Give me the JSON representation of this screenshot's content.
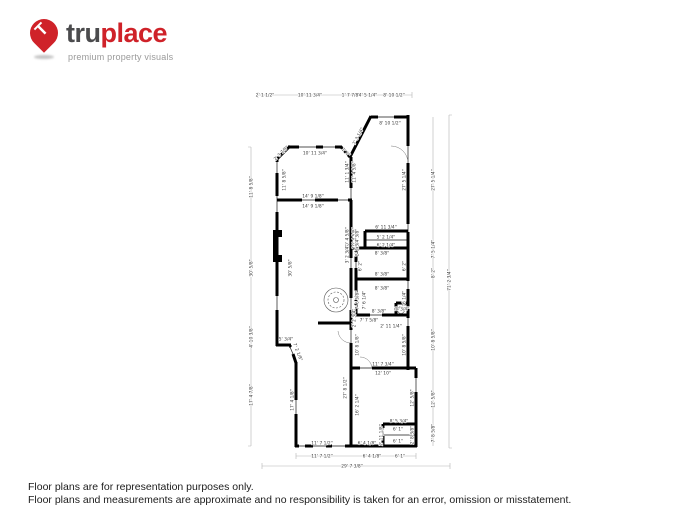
{
  "logo": {
    "pin_letter": "T",
    "brand_bold": "tru",
    "brand_accent": "place",
    "tagline": "premium property visuals",
    "accent_color": "#cf2229",
    "text_color": "#4b4b4d"
  },
  "disclaimer": {
    "line1": "Floor plans are for representation purposes only.",
    "line2": "Floor plans and measurements are approximate and no responsibility is taken for an error, omission or misstatement."
  },
  "floorplan": {
    "labels": [
      {
        "t": "2' 1 1/2\"",
        "x": 265,
        "y": 95,
        "r": 0
      },
      {
        "t": "10' 11 3/4\"",
        "x": 310,
        "y": 95,
        "r": 0
      },
      {
        "t": "1' 7 7/8\"",
        "x": 351,
        "y": 95,
        "r": 0
      },
      {
        "t": "4' 5 1/4\"",
        "x": 368,
        "y": 95,
        "r": 0
      },
      {
        "t": "8' 10 1/2\"",
        "x": 394,
        "y": 95,
        "r": 0
      },
      {
        "t": "8' 10 1/2\"",
        "x": 390,
        "y": 123,
        "r": 0
      },
      {
        "t": "10' 11 3/4\"",
        "x": 315,
        "y": 153,
        "r": 0
      },
      {
        "t": "2' 3 7/8\"",
        "x": 281,
        "y": 153,
        "r": -45
      },
      {
        "t": "1' 1\"",
        "x": 346,
        "y": 152,
        "r": 45
      },
      {
        "t": "7' 3 1/4\"",
        "x": 358,
        "y": 136,
        "r": -62
      },
      {
        "t": "11' 8 5/8\"",
        "x": 251,
        "y": 187,
        "r": -90
      },
      {
        "t": "30' 5/8\"",
        "x": 251,
        "y": 268,
        "r": -90
      },
      {
        "t": "4' 10 3/8\"",
        "x": 251,
        "y": 337,
        "r": -90
      },
      {
        "t": "17' 4 7/8\"",
        "x": 251,
        "y": 395,
        "r": -90
      },
      {
        "t": "11' 8 5/8\"",
        "x": 284,
        "y": 180,
        "r": -90
      },
      {
        "t": "30' 5/8\"",
        "x": 290,
        "y": 268,
        "r": -90
      },
      {
        "t": "11' 1 3/4\"",
        "x": 347,
        "y": 172,
        "r": -90
      },
      {
        "t": "11' 4 5/8\"",
        "x": 354,
        "y": 172,
        "r": -90
      },
      {
        "t": "10' 4 5/8\"",
        "x": 347,
        "y": 238,
        "r": -90
      },
      {
        "t": "10' 4 5/8\"",
        "x": 354,
        "y": 238,
        "r": -90
      },
      {
        "t": "27' 5 1/4\"",
        "x": 404,
        "y": 180,
        "r": -90
      },
      {
        "t": "27' 5 1/4\"",
        "x": 433,
        "y": 180,
        "r": -90
      },
      {
        "t": "7' 5 1/4\"",
        "x": 433,
        "y": 249,
        "r": -90
      },
      {
        "t": "8' 2\"",
        "x": 433,
        "y": 273,
        "r": -90
      },
      {
        "t": "10' 8 5/8\"",
        "x": 433,
        "y": 340,
        "r": -90
      },
      {
        "t": "12' 5/8\"",
        "x": 433,
        "y": 399,
        "r": -90
      },
      {
        "t": "7' 8 5/8\"",
        "x": 433,
        "y": 433,
        "r": -90
      },
      {
        "t": "71' 2 3/4\"",
        "x": 449,
        "y": 280,
        "r": -90
      },
      {
        "t": "14' 9 1/8\"",
        "x": 313,
        "y": 196,
        "r": 0
      },
      {
        "t": "14' 9 1/8\"",
        "x": 313,
        "y": 206,
        "r": 0
      },
      {
        "t": "6' 11 3/4\"",
        "x": 386,
        "y": 227,
        "r": 0
      },
      {
        "t": "5' 2 1/4\"",
        "x": 386,
        "y": 237,
        "r": 0
      },
      {
        "t": "6' 2 1/4\"",
        "x": 386,
        "y": 245,
        "r": 0
      },
      {
        "t": "2' 2 3/8\"",
        "x": 357,
        "y": 238,
        "r": -90
      },
      {
        "t": "2' 2 3/4\"",
        "x": 357,
        "y": 247,
        "r": -90
      },
      {
        "t": "3' 2 3/4\"",
        "x": 347,
        "y": 254,
        "r": -90
      },
      {
        "t": "8' 3/8\"",
        "x": 382,
        "y": 253,
        "r": 0
      },
      {
        "t": "8' 3/8\"",
        "x": 382,
        "y": 274,
        "r": 0
      },
      {
        "t": "8' 3/8\"",
        "x": 382,
        "y": 288,
        "r": 0
      },
      {
        "t": "6' 2\"",
        "x": 360,
        "y": 266,
        "r": -90
      },
      {
        "t": "6' 2\"",
        "x": 404,
        "y": 266,
        "r": -90
      },
      {
        "t": "7' 6 5/8\"",
        "x": 357,
        "y": 300,
        "r": -90
      },
      {
        "t": "7' 6 1/4\"",
        "x": 364,
        "y": 300,
        "r": -90
      },
      {
        "t": "7' 6 1/4\"",
        "x": 404,
        "y": 300,
        "r": -90
      },
      {
        "t": "8' 3/8\"",
        "x": 379,
        "y": 311,
        "r": 0
      },
      {
        "t": "2' 2 3/4\"",
        "x": 354,
        "y": 318,
        "r": -90
      },
      {
        "t": "7' 7 5/8\"",
        "x": 369,
        "y": 320,
        "r": 0
      },
      {
        "t": "1' 3/4\"",
        "x": 402,
        "y": 309,
        "r": 0
      },
      {
        "t": "2' 11 1/4\"",
        "x": 391,
        "y": 326,
        "r": 0
      },
      {
        "t": "5' 3/4\"",
        "x": 286,
        "y": 339,
        "r": 0
      },
      {
        "t": "7' 2 1/8\"",
        "x": 298,
        "y": 352,
        "r": 68
      },
      {
        "t": "10' 8 1/8\"",
        "x": 357,
        "y": 345,
        "r": -90
      },
      {
        "t": "10' 8 5/8\"",
        "x": 404,
        "y": 345,
        "r": -90
      },
      {
        "t": "11' 7 3/4\"",
        "x": 383,
        "y": 364,
        "r": 0
      },
      {
        "t": "12' 10\"",
        "x": 383,
        "y": 373,
        "r": 0
      },
      {
        "t": "27' 8 1/2\"",
        "x": 345,
        "y": 388,
        "r": -90
      },
      {
        "t": "16' 2 1/4\"",
        "x": 357,
        "y": 405,
        "r": -90
      },
      {
        "t": "12' 5/8\"",
        "x": 412,
        "y": 398,
        "r": -90
      },
      {
        "t": "17' 4 1/8\"",
        "x": 292,
        "y": 400,
        "r": -90
      },
      {
        "t": "8' 5 3/4\"",
        "x": 399,
        "y": 421,
        "r": 0
      },
      {
        "t": "2' 11 1/8\"",
        "x": 381,
        "y": 435,
        "r": -90
      },
      {
        "t": "6' 1\"",
        "x": 398,
        "y": 429,
        "r": 0
      },
      {
        "t": "6' 1\"",
        "x": 398,
        "y": 441,
        "r": 0
      },
      {
        "t": "2' 8 3/8\"",
        "x": 412,
        "y": 435,
        "r": -90
      },
      {
        "t": "6' 4 1/8\"",
        "x": 367,
        "y": 443,
        "r": 0
      },
      {
        "t": "11' 7 1/2\"",
        "x": 322,
        "y": 443,
        "r": 0
      },
      {
        "t": "11' 7 1/2\"",
        "x": 322,
        "y": 456,
        "r": 0
      },
      {
        "t": "6' 4 1/8\"",
        "x": 372,
        "y": 456,
        "r": 0
      },
      {
        "t": "6' 1\"",
        "x": 400,
        "y": 456,
        "r": 0
      },
      {
        "t": "29' 7 3/8\"",
        "x": 352,
        "y": 466,
        "r": 0
      }
    ]
  }
}
